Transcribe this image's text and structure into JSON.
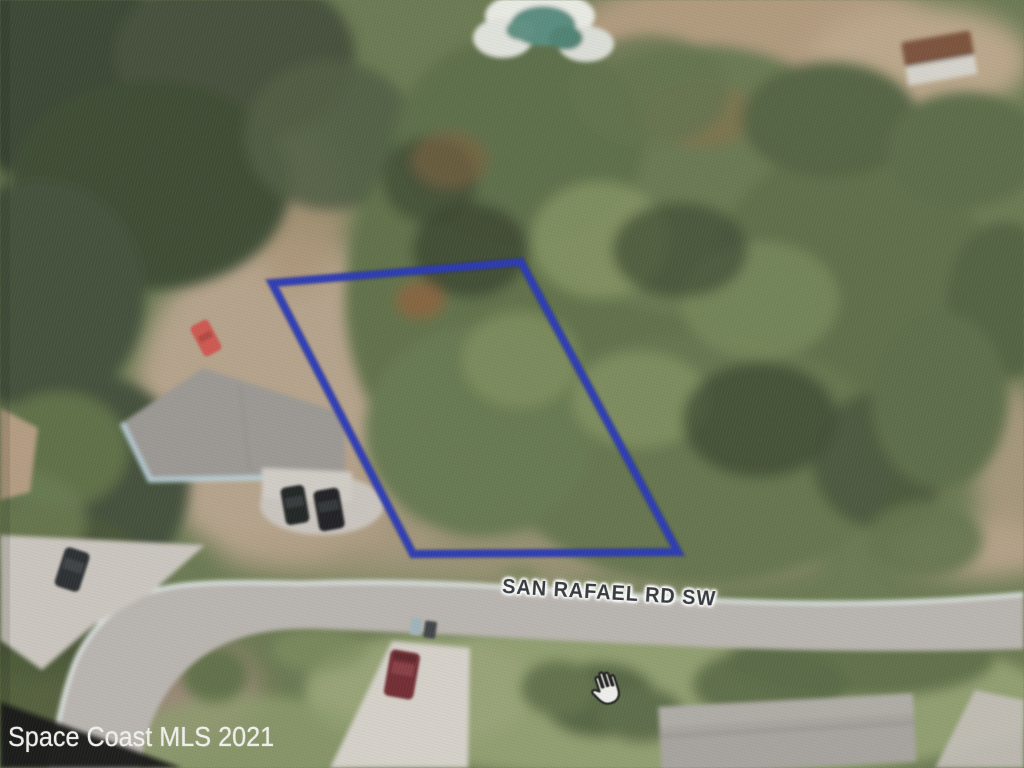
{
  "map": {
    "road_label": "SAN RAFAEL RD SW",
    "parcel_outline_points": "272,283 521,262 678,552 413,554",
    "parcel_outline_color": "#2032c4",
    "parcel_outline_shadow_color": "#141f7a",
    "cursor_icon": "hand-grab"
  },
  "watermark": {
    "text": "Space Coast MLS 2021",
    "text_color": "#f2f2ef",
    "band_color": "#0c0d0f"
  }
}
